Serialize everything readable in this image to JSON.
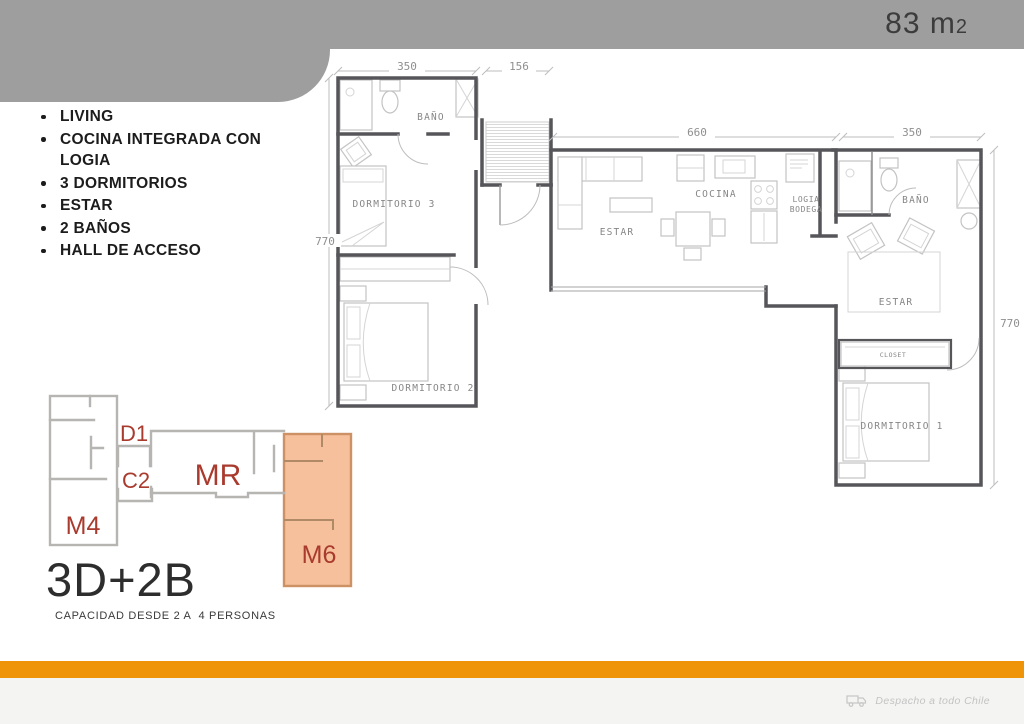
{
  "theme": {
    "band-gray": "#9e9e9e",
    "accent-orange": "#ef9309",
    "m6-fill": "#f5c09b",
    "m6-border": "#cd9166",
    "unit-red": "#a93a2e",
    "footer-bg": "#f4f4f2"
  },
  "header": {
    "area_value": "83 m",
    "area_exponent": "2"
  },
  "features": {
    "items": [
      "LIVING",
      "COCINA INTEGRADA CON LOGIA",
      "3 DORMITORIOS",
      "ESTAR",
      "2 BAÑOS",
      "HALL DE ACCESO"
    ]
  },
  "floor_plan": {
    "dimensions": {
      "top_left_width": "350",
      "hall_width": "156",
      "left_height": "770",
      "living_width": "660",
      "right_width": "350",
      "right_height": "770"
    },
    "rooms": {
      "bath_left": "BAÑO",
      "bedroom3": "DORMITORIO 3",
      "bedroom2": "DORMITORIO 2",
      "living": "ESTAR",
      "kitchen": "COCINA",
      "logia_line1": "LOGIA",
      "logia_line2": "BODEGA",
      "bath_right": "BAÑO",
      "sitting": "ESTAR",
      "closet": "CLOSET",
      "bedroom1": "DORMITORIO 1"
    }
  },
  "key_plan": {
    "units": {
      "m4": "M4",
      "d1": "D1",
      "c2": "C2",
      "mr": "MR",
      "m6": "M6"
    },
    "highlighted": "M6"
  },
  "summary": {
    "title": "3D+2B",
    "capacity": "CAPACIDAD DESDE 2 A  4 PERSONAS"
  },
  "footer": {
    "shipping_note": "Despacho a todo Chile"
  }
}
